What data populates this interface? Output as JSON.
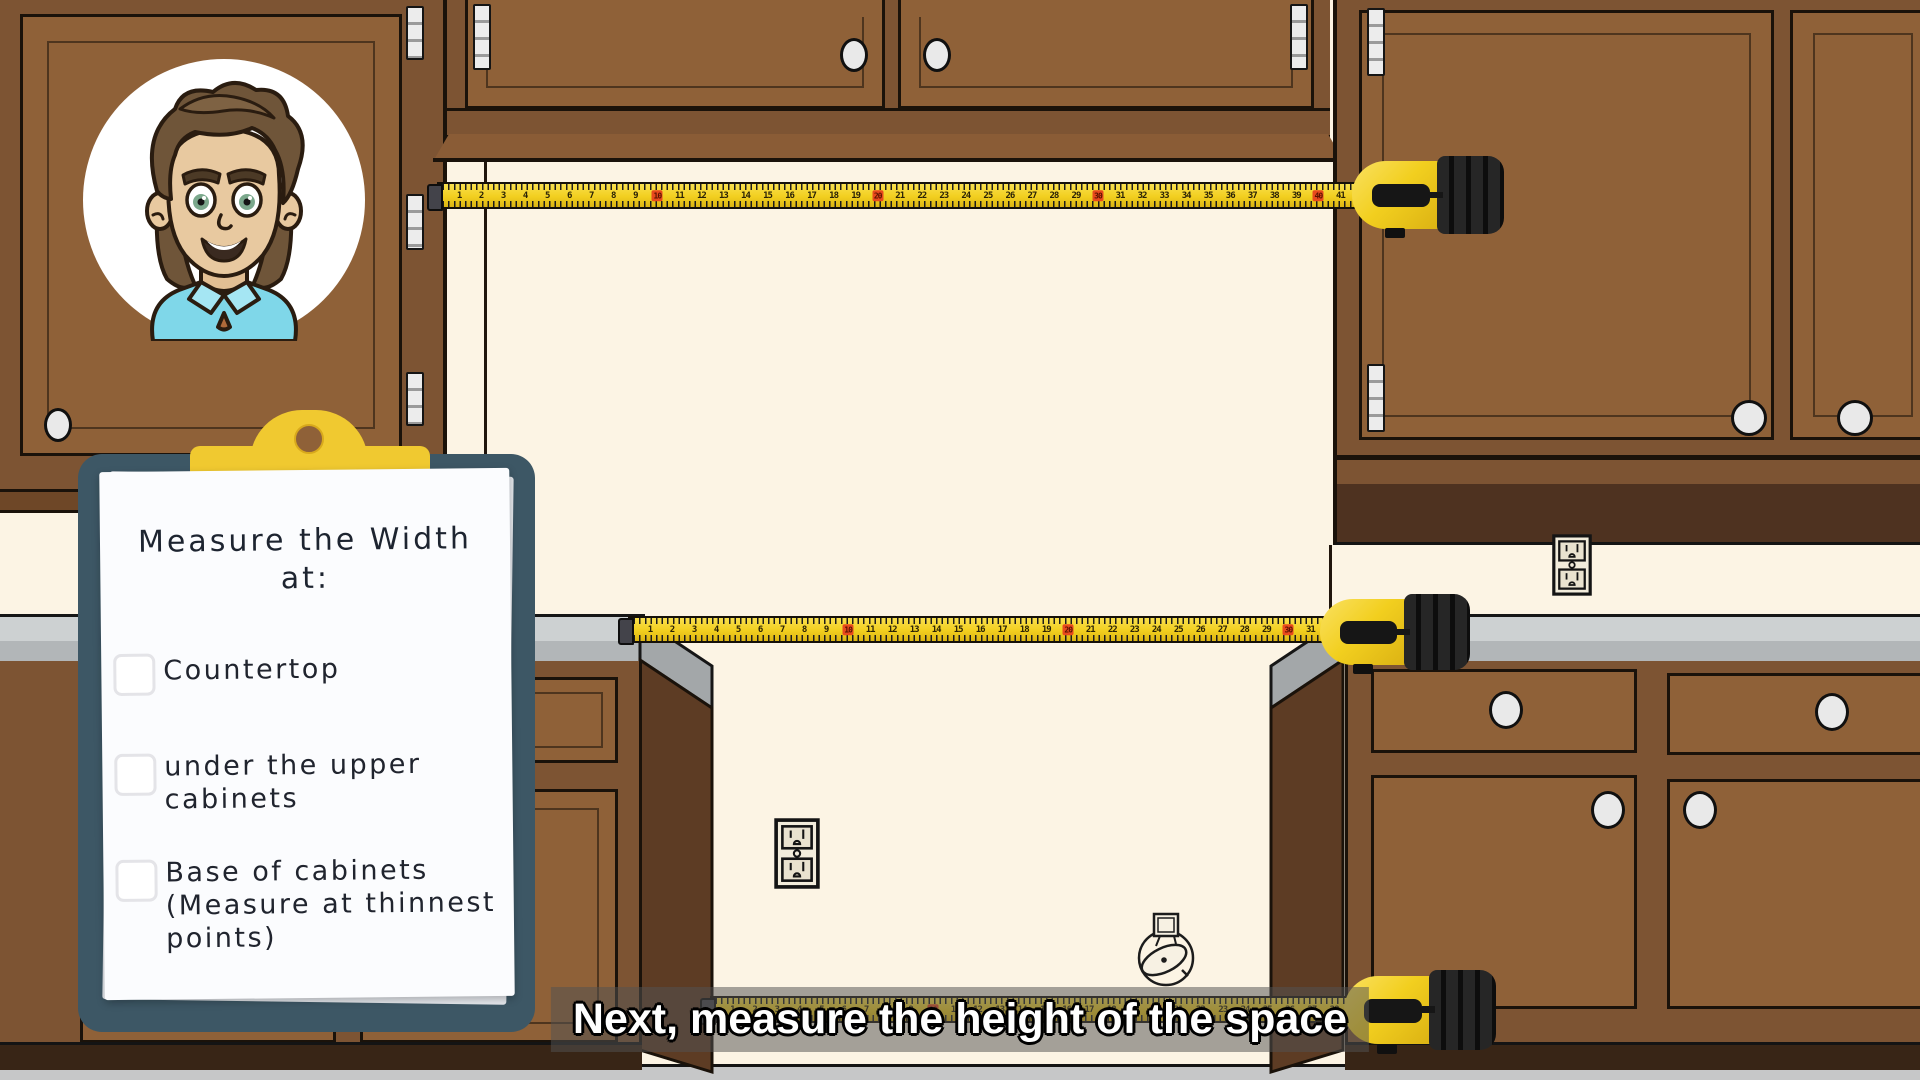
{
  "clipboard": {
    "title_line1": "Measure the Width",
    "title_line2": "at:",
    "items": [
      {
        "label": "Countertop",
        "checked": false
      },
      {
        "label": "under the upper cabinets",
        "checked": false
      },
      {
        "label": "Base of cabinets (Measure at thinnest points)",
        "checked": false
      }
    ]
  },
  "caption": {
    "text": "Next, measure the height of the space"
  },
  "tapes": {
    "upper": {
      "start": 1,
      "end": 41,
      "marker_every": 10
    },
    "middle": {
      "start": 1,
      "end": 31,
      "marker_every": 10
    },
    "bottom": {
      "start": 1,
      "end": 28,
      "marker_every": 10
    }
  },
  "colors": {
    "wall": "#fcf4e4",
    "cabinet_frame": "#7d5433",
    "cabinet_face": "#8f6138",
    "cabinet_dark": "#4e3220",
    "countertop": "#cdd1d2",
    "countertop_edge": "#b2b6b8",
    "floor": "#c6c7c8",
    "tape_yellow": "#f2cf1f",
    "tape_marker_red": "#e8491d",
    "clipboard_board": "#3d5765",
    "clipboard_clip": "#f0c930",
    "paper": "#fbfcfe",
    "caption_bg": "rgba(82,82,82,0.52)",
    "caption_text": "#ffffff",
    "shirt_blue": "#7fd7e9"
  }
}
